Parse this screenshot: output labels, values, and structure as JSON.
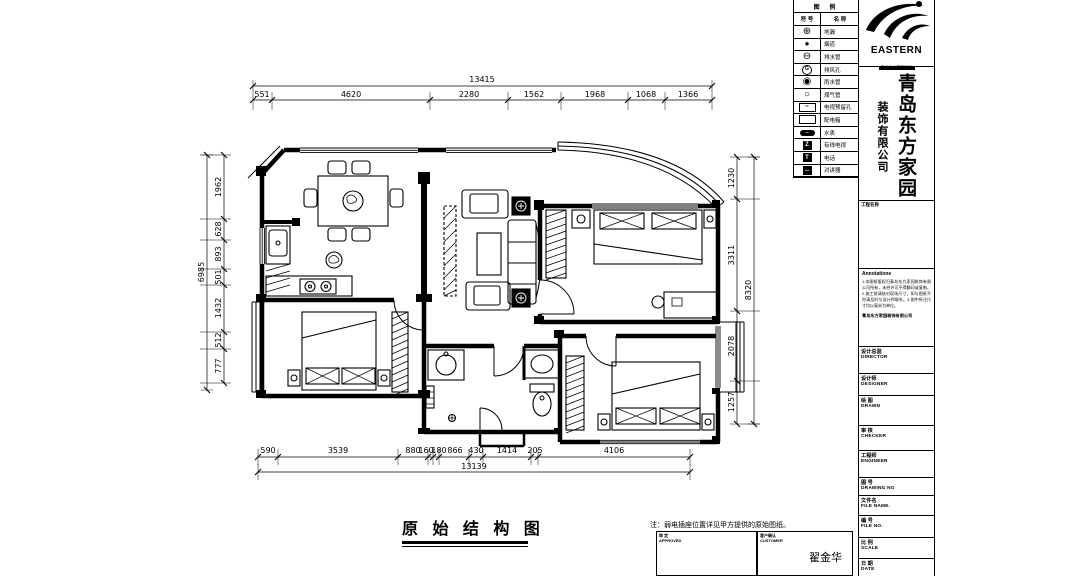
{
  "sheet": {
    "plan_title": "原 始 结 构 图",
    "note": "注：弱电插座位置详见甲方提供的原始图纸。",
    "signature": {
      "left_label_cn": "审 定",
      "left_label_en": "APPROVED",
      "right_label_cn": "客户确认",
      "right_label_en": "CUSTOMER",
      "name": "翟金华"
    }
  },
  "legend": {
    "title": "图 例",
    "col_symbol": "符 号",
    "col_name": "名 称",
    "items": [
      {
        "icon": "floor-drain",
        "label": "地漏"
      },
      {
        "icon": "flue",
        "label": "烟道"
      },
      {
        "icon": "drain-pipe",
        "label": "排水管"
      },
      {
        "icon": "vent-hole",
        "label": "排风孔"
      },
      {
        "icon": "rain-pipe",
        "label": "雨水管"
      },
      {
        "icon": "gas-pipe",
        "label": "煤气管"
      },
      {
        "icon": "tv-hole",
        "label": "电视预留孔"
      },
      {
        "icon": "power-box",
        "label": "配电箱"
      },
      {
        "icon": "water-meter",
        "label": "水表"
      },
      {
        "icon": "cable-tv",
        "label": "有线电视"
      },
      {
        "icon": "phone",
        "label": "电话"
      },
      {
        "icon": "intercom",
        "label": "对讲器"
      }
    ]
  },
  "titleblock": {
    "logo_text": "EASTERN",
    "logo_caption": "青岛东方家园装饰",
    "company_name": "青岛东方家园",
    "company_suffix": "装饰有限公司",
    "project_label": "工程名称",
    "annotations_heading": "Annotations",
    "annotations_body": "1.本图纸版权归青岛东方家园装饰有限公司所有，未经许可不得翻印或复制。2.施工前请核对现场尺寸，如与图纸不符请及时与设计师联系。3.图中所注尺寸均以毫米为单位。",
    "annotations_footer": "青岛东方家园装饰有限公司",
    "fields": [
      {
        "cn": "设计总监",
        "en": "DIRECTOR"
      },
      {
        "cn": "设计师",
        "en": "DESIGNER"
      },
      {
        "cn": "绘 图",
        "en": "DRAWN"
      },
      {
        "cn": "审 核",
        "en": "CHECKER"
      },
      {
        "cn": "工程师",
        "en": "ENGINEER"
      },
      {
        "cn": "图 号",
        "en": "DRAWING NO"
      },
      {
        "cn": "文件名",
        "en": "FILE NAME."
      },
      {
        "cn": "编 号",
        "en": "FILE NO."
      },
      {
        "cn": "比 例",
        "en": "SCALE"
      },
      {
        "cn": "日 期",
        "en": "DATE"
      }
    ]
  },
  "dims": {
    "top_total": "13415",
    "top": [
      "551",
      "4620",
      "2280",
      "1562",
      "1968",
      "1068",
      "1366"
    ],
    "bottom": [
      "590",
      "3539",
      "880",
      "160",
      "180",
      "866",
      "430",
      "1414",
      "205",
      "4106"
    ],
    "bottom_total": "13139",
    "left": [
      "1962",
      "628",
      "893",
      "501",
      "1432",
      "512",
      "777"
    ],
    "left_total": "6985",
    "right": [
      "1230",
      "3311",
      "2078",
      "1257"
    ],
    "right_total": "8320"
  }
}
